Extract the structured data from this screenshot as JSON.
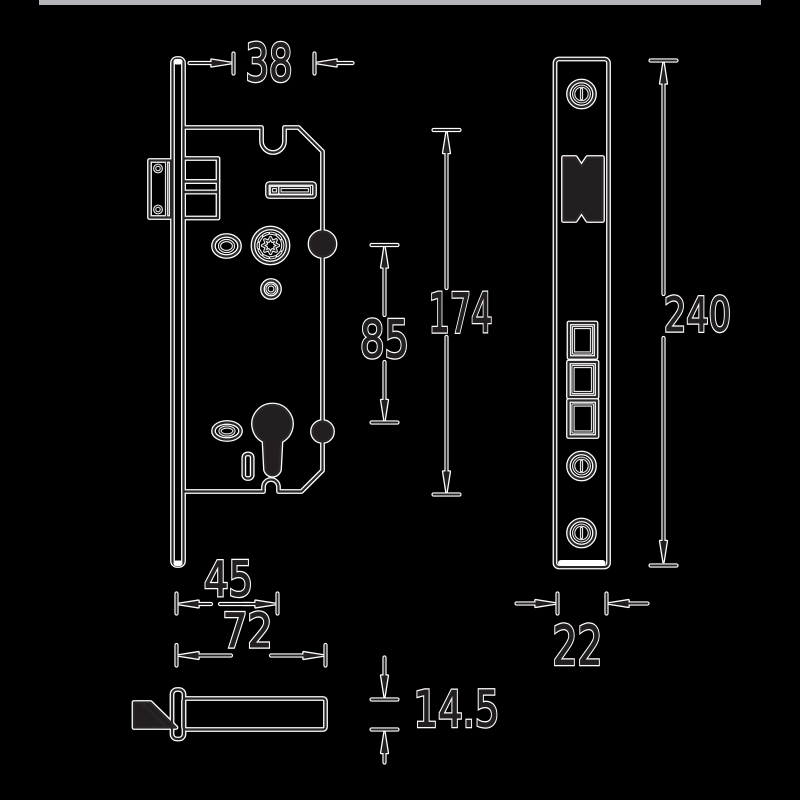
{
  "page": {
    "background": "#000000",
    "top_bar_color": "#b3b5b8"
  },
  "drawing": {
    "subject": "mortise-lock-technical-drawing",
    "colors": {
      "halo": "#ffffff",
      "line_core": "#2b2728",
      "ink": "#231f20"
    },
    "dimensions": {
      "backset": {
        "label": "38"
      },
      "case_height": {
        "label": "174"
      },
      "handle_to_cylinder": {
        "label": "85"
      },
      "faceplate_to_cylinder": {
        "label": "45"
      },
      "case_depth": {
        "label": "72"
      },
      "latch_size": {
        "label": "14.5"
      },
      "faceplate_length": {
        "label": "240"
      },
      "faceplate_width": {
        "label": "22"
      }
    }
  }
}
